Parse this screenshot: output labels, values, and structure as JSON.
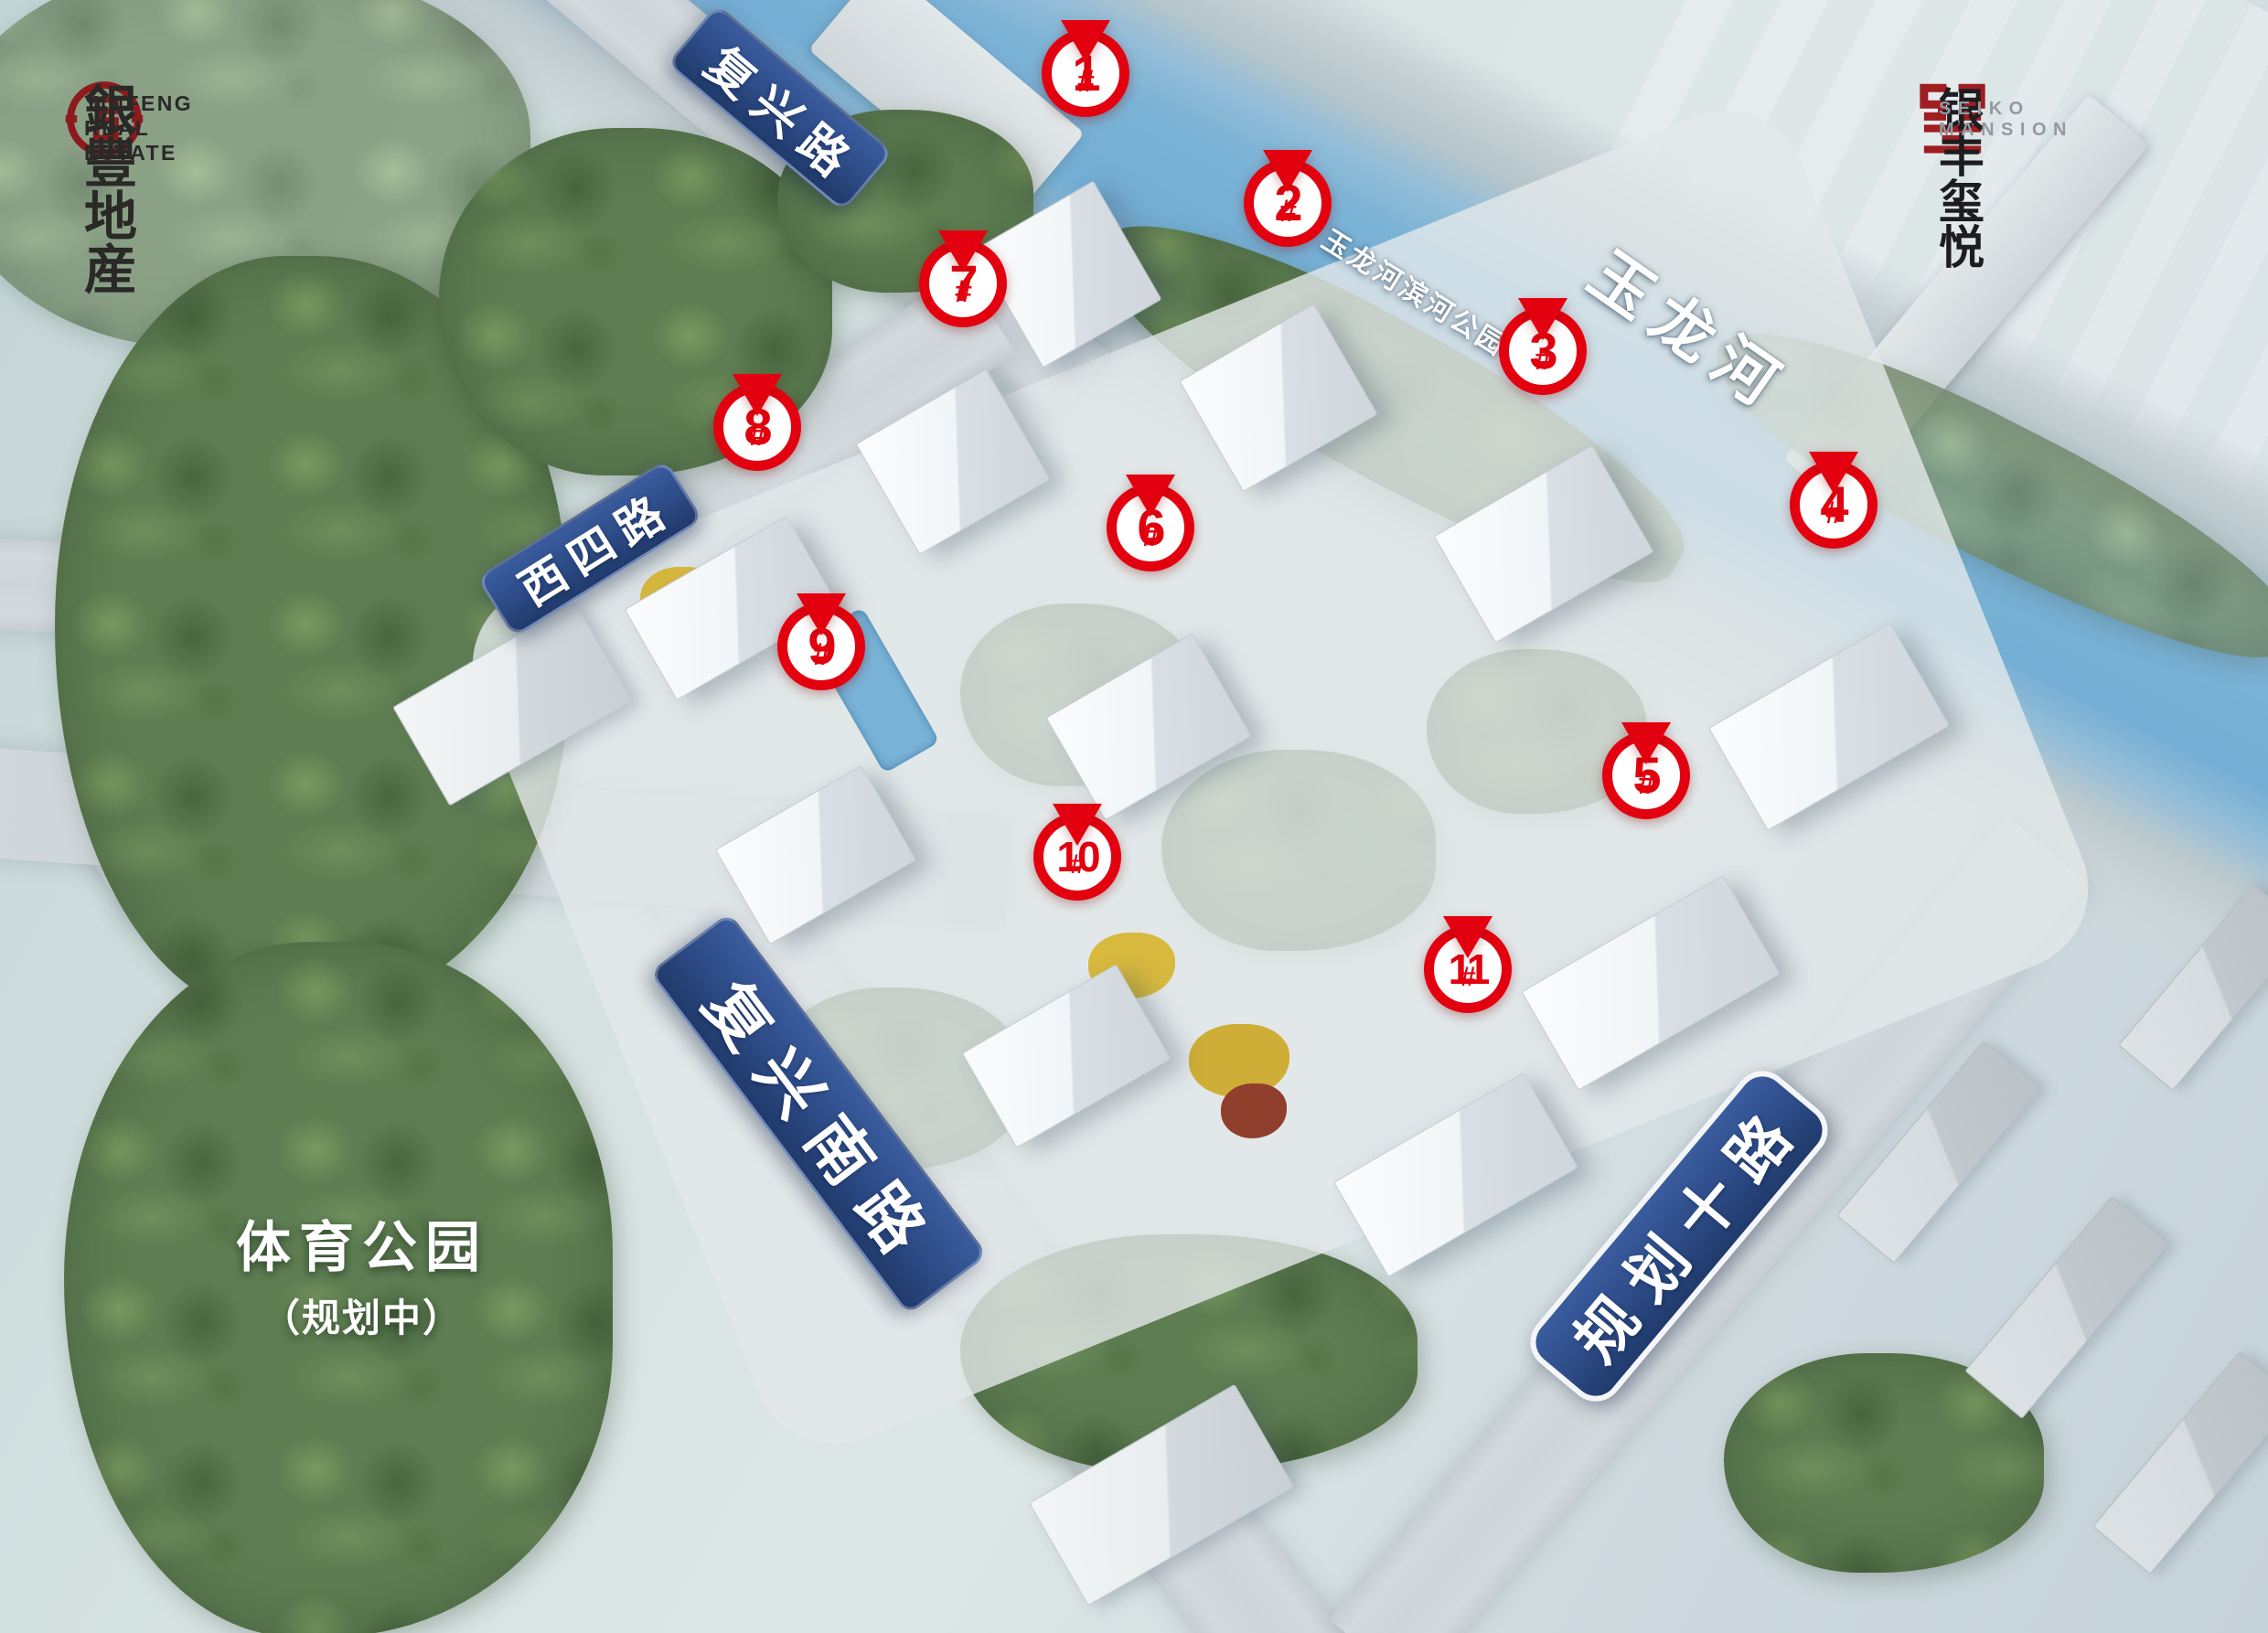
{
  "branding": {
    "developer": {
      "name_cn": "銀豐地産",
      "name_en": "YINFENG REAL ESTATE"
    },
    "project": {
      "name_cn": "银丰玺悦",
      "name_en": "SEIKO MANSION"
    }
  },
  "markers": [
    {
      "num": "1",
      "suffix": "#"
    },
    {
      "num": "2",
      "suffix": "#"
    },
    {
      "num": "3",
      "suffix": "#"
    },
    {
      "num": "4",
      "suffix": "#"
    },
    {
      "num": "5",
      "suffix": "#"
    },
    {
      "num": "6",
      "suffix": "#"
    },
    {
      "num": "7",
      "suffix": "#"
    },
    {
      "num": "8",
      "suffix": "#"
    },
    {
      "num": "9",
      "suffix": "#"
    },
    {
      "num": "10",
      "suffix": "#"
    },
    {
      "num": "11",
      "suffix": "#"
    }
  ],
  "roads": [
    {
      "name": "复兴路"
    },
    {
      "name": "西四路"
    },
    {
      "name": "复兴南路"
    },
    {
      "name": "规划十路"
    }
  ],
  "river": {
    "name": "玉龙河"
  },
  "parks": {
    "riverside": {
      "name": "玉龙河滨河公园"
    },
    "sports": {
      "name": "体育公园",
      "status": "（规划中）"
    }
  },
  "colors": {
    "marker_red": "#e3000f",
    "banner_blue": "#2c4a85",
    "logo_red": "#8e1a1e",
    "river_blue": "#74aed4"
  }
}
